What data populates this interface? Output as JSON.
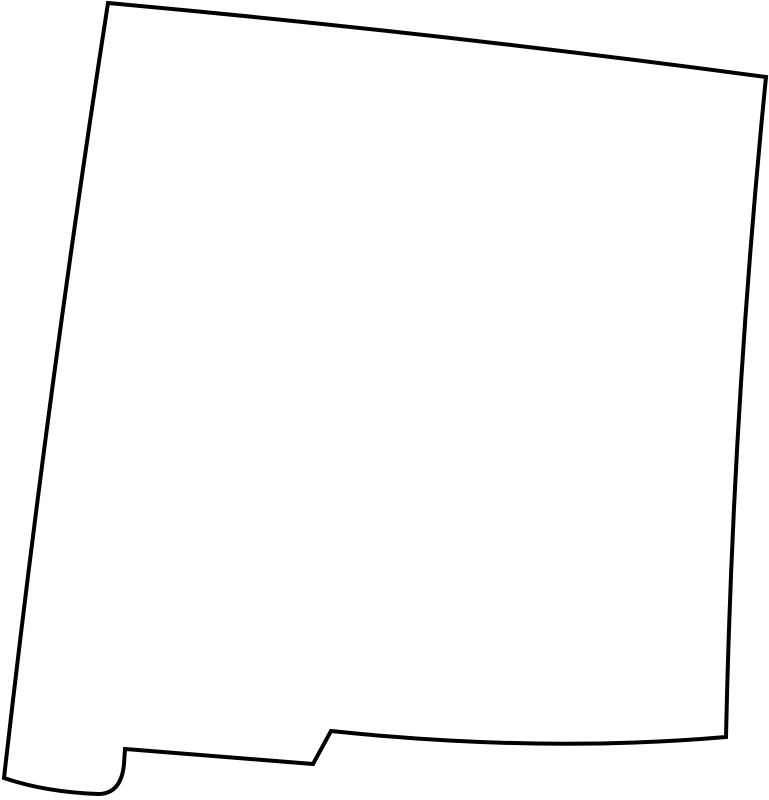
{
  "page": {
    "background_color": "#ffffff"
  },
  "map": {
    "region_name": "New Mexico",
    "kind": "blank-state-outline-map",
    "stroke_color": "#000000",
    "fill_color": "#ffffff",
    "stroke_width": "4px",
    "view_box": "0 0 769 800",
    "outline_path": "M 108,3 Q 438,33 766,77 Q 733,407 726,737 Q 540,753 331,731 L 313,764 L 125,749 L 124,764 C 122,786 112,794 98,794 Q 45,792 4,778 Q 48,390 108,3 Z"
  }
}
